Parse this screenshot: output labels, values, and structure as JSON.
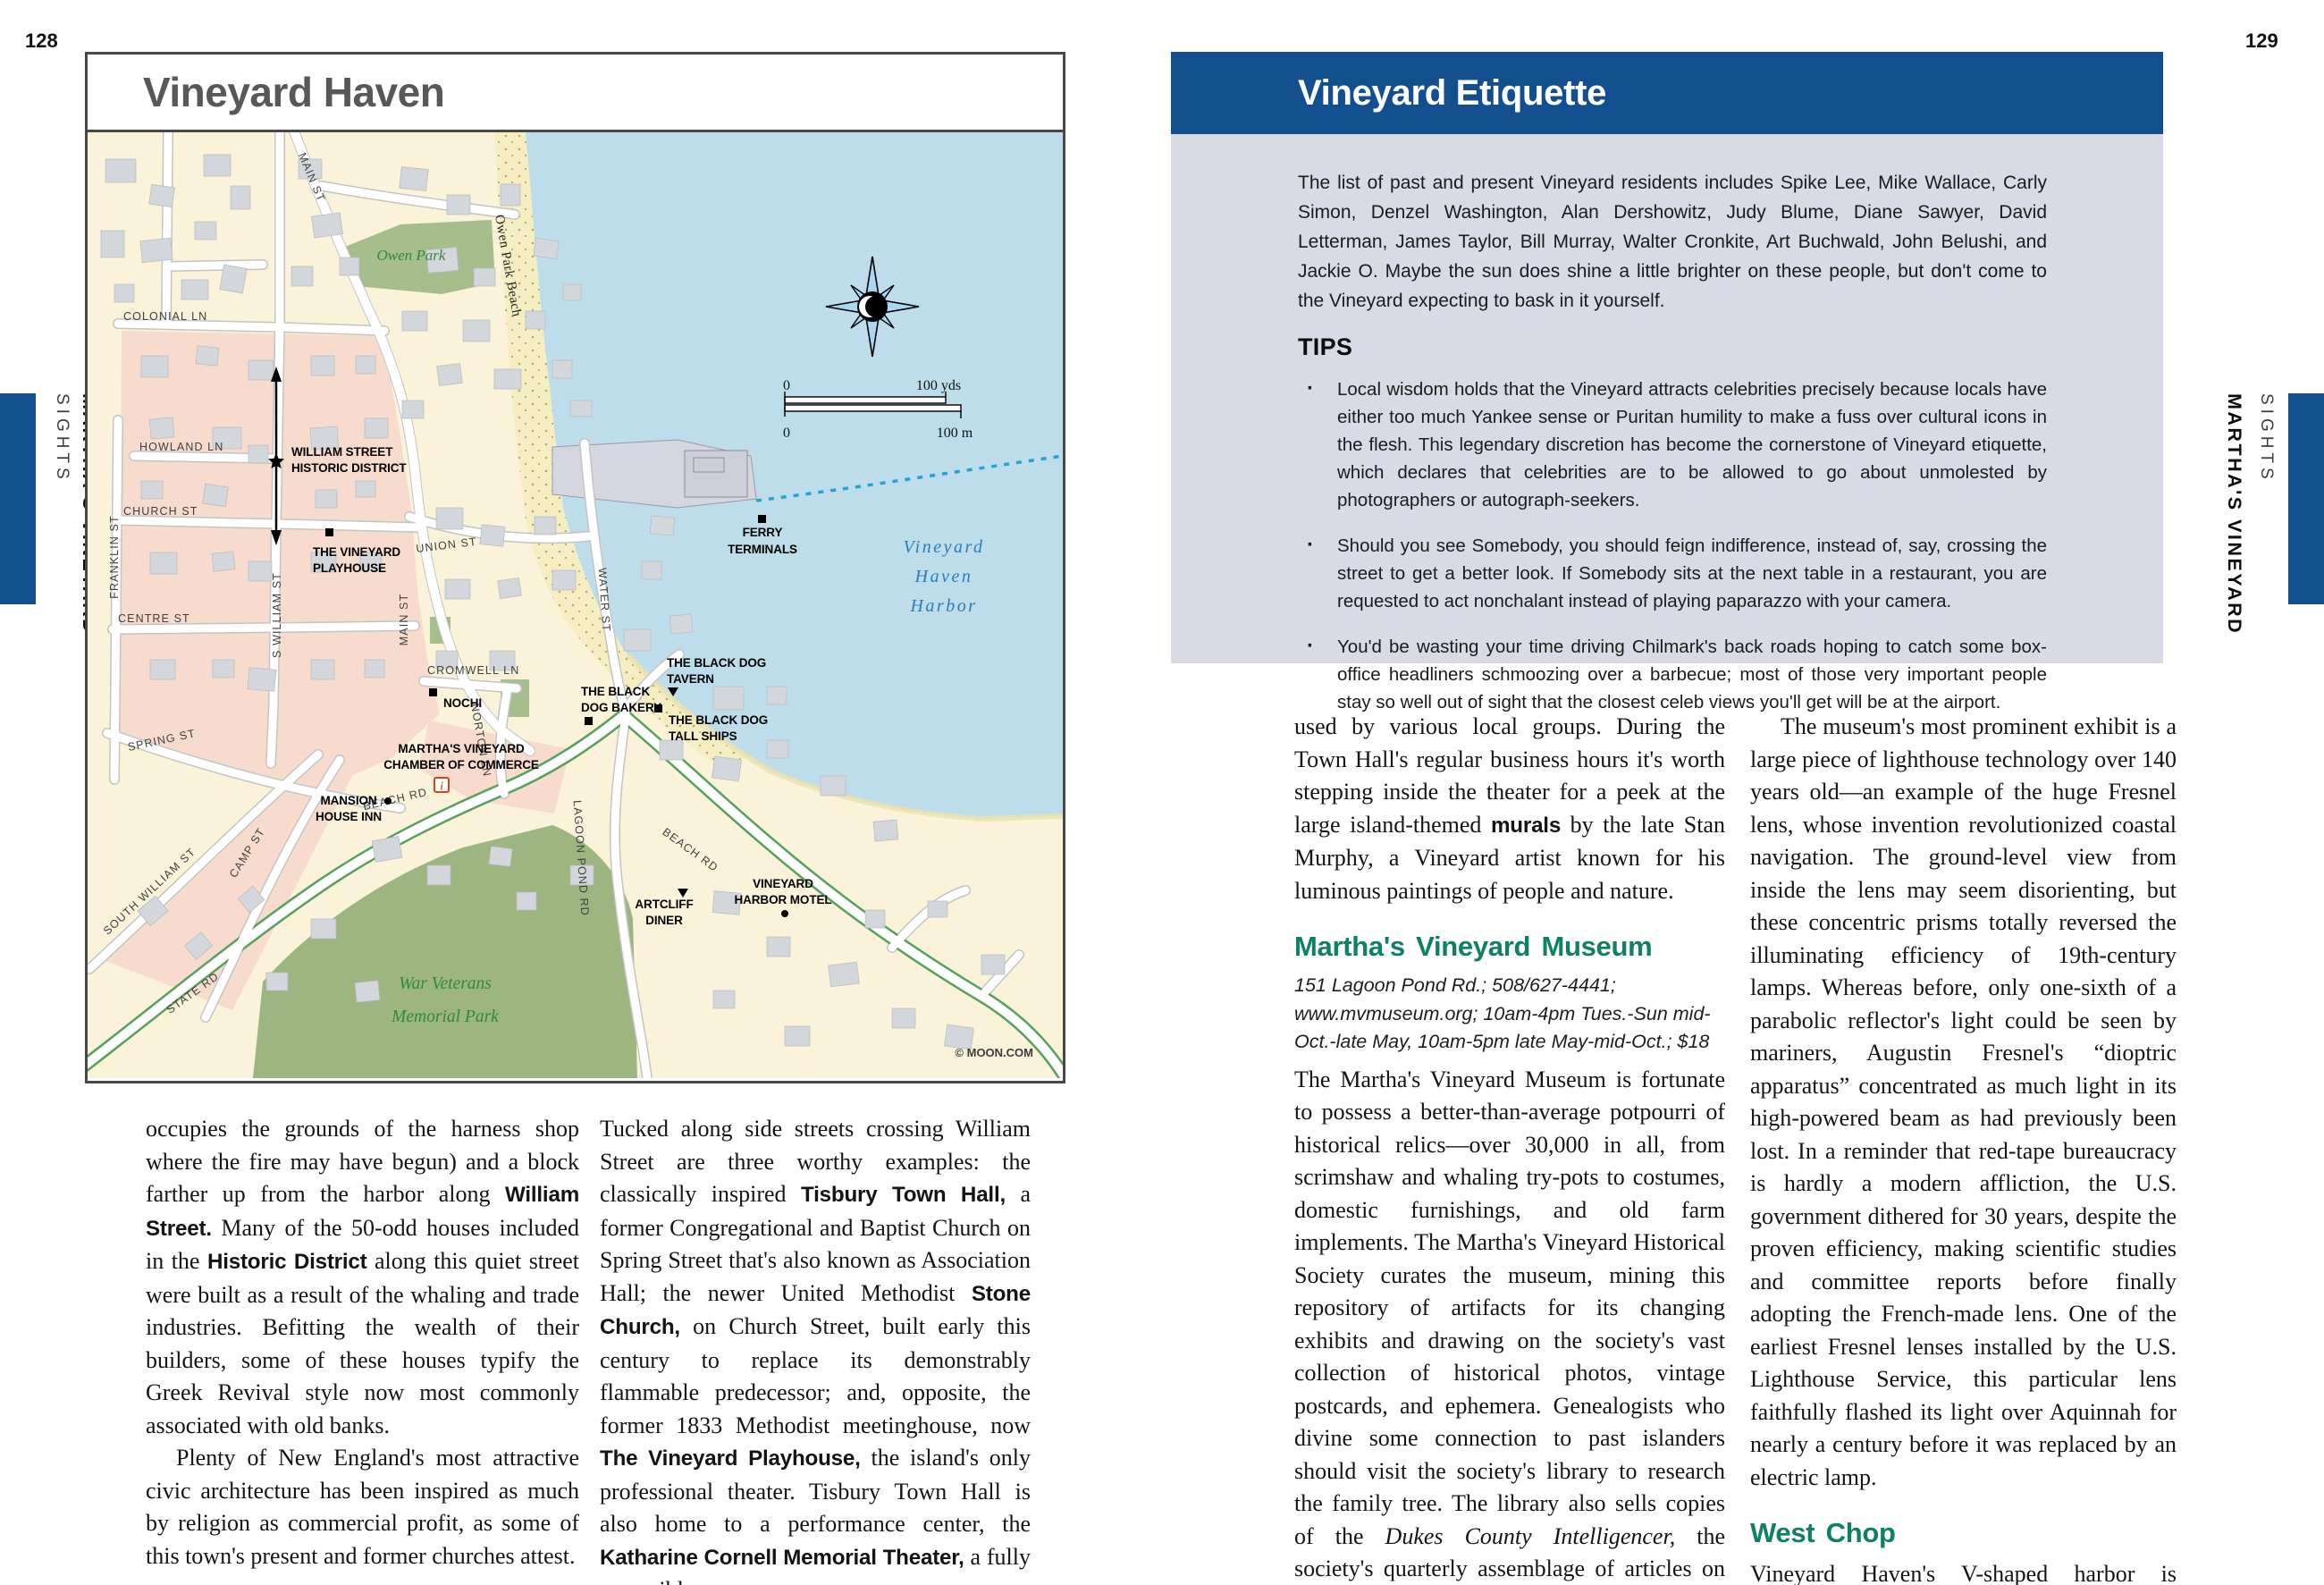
{
  "page_numbers": {
    "left": "128",
    "right": "129"
  },
  "tabs": {
    "chapter": "MARTHA'S VINEYARD",
    "section": "SIGHTS"
  },
  "colors": {
    "accent_blue": "#134f8e",
    "box_lavender": "#d8dbe6",
    "heading_green": "#0e8066",
    "map_water": "#bdddeb",
    "map_land": "#faf3da",
    "map_pink": "#f7dcce",
    "map_park": "#a6bd8e",
    "map_beach": "#f5eec2",
    "map_green_text": "#2f8a3f",
    "harbor_text_blue": "#2e7cb5"
  },
  "map": {
    "title": "Vineyard Haven",
    "copyright": "© MOON.COM",
    "info_icon_glyph": "i",
    "streets": {
      "main_upper": "MAIN ST",
      "main_lower": "MAIN ST",
      "colonial": "COLONIAL LN",
      "howland": "HOWLAND LN",
      "church": "CHURCH ST",
      "centre": "CENTRE ST",
      "spring": "SPRING ST",
      "franklin": "FRANKLIN ST",
      "s_william": "S WILLIAM ST",
      "union": "UNION ST",
      "water": "WATER ST",
      "cromwell": "CROMWELL LN",
      "norton": "NORTON LN",
      "beach_1": "BEACH RD",
      "beach_2": "BEACH RD",
      "lagoon": "LAGOON POND RD",
      "south_william": "SOUTH WILLIAM ST",
      "camp": "CAMP ST",
      "state": "STATE RD"
    },
    "pois": {
      "historic_1": "WILLIAM STREET",
      "historic_2": "HISTORIC DISTRICT",
      "playhouse_1": "THE VINEYARD",
      "playhouse_2": "PLAYHOUSE",
      "ferry_1": "FERRY",
      "ferry_2": "TERMINALS",
      "tavern_1": "THE BLACK DOG",
      "tavern_2": "TAVERN",
      "bakery_1": "THE BLACK",
      "bakery_2": "DOG BAKERY",
      "tallships_1": "THE BLACK DOG",
      "tallships_2": "TALL SHIPS",
      "nochi": "NOCHI",
      "chamber_1": "MARTHA'S VINEYARD",
      "chamber_2": "CHAMBER OF COMMERCE",
      "mansion_1": "MANSION",
      "mansion_2": "HOUSE INN",
      "artcliff_1": "ARTCLIFF",
      "artcliff_2": "DINER",
      "motel_1": "VINEYARD",
      "motel_2": "HARBOR MOTEL"
    },
    "parks": {
      "owen": "Owen Park",
      "owen_beach": "Owen Park Beach",
      "war_1": "War Veterans",
      "war_2": "Memorial Park"
    },
    "harbor": {
      "l1": "Vineyard",
      "l2": "Haven",
      "l3": "Harbor"
    },
    "scale": {
      "y0": "0",
      "yds": "100 yds",
      "m0": "0",
      "m": "100 m"
    }
  },
  "left_col1": {
    "p1": [
      {
        "t": "occupies the grounds of the harness shop where the fire may have begun) and a block farther up from the harbor along "
      },
      {
        "t": "William Street.",
        "c": "b"
      },
      {
        "t": " Many of the 50-odd houses included in the "
      },
      {
        "t": "Historic District",
        "c": "b"
      },
      {
        "t": " along this quiet street were built as a result of the whaling and trade industries. Befitting the wealth of their builders, some of these houses typify the Greek Revival style now most commonly associated with old banks."
      }
    ],
    "p2": [
      {
        "t": "Plenty of New England's most attractive civic architecture has been inspired as much by religion as commercial profit, as some of this town's present and former churches attest."
      }
    ]
  },
  "left_col2": {
    "p1": [
      {
        "t": "Tucked along side streets crossing William Street are three worthy examples: the classically inspired "
      },
      {
        "t": "Tisbury Town Hall,",
        "c": "b"
      },
      {
        "t": " a former Congregational and Baptist Church on Spring Street that's also known as Association Hall; the newer United Methodist "
      },
      {
        "t": "Stone Church,",
        "c": "b"
      },
      {
        "t": " on Church Street, built early this century to replace its demonstrably flammable predecessor; and, opposite, the former 1833 Methodist meetinghouse, now "
      },
      {
        "t": "The Vineyard Playhouse,",
        "c": "b"
      },
      {
        "t": " the island's only professional theater. Tisbury Town Hall is also home to a performance center, the "
      },
      {
        "t": "Katharine Cornell Memorial Theater,",
        "c": "b"
      },
      {
        "t": " a fully accessible space"
      }
    ]
  },
  "etiquette": {
    "title": "Vineyard Etiquette",
    "intro": "The list of past and present Vineyard residents includes Spike Lee, Mike Wallace, Carly Simon, Denzel Washington, Alan Dershowitz, Judy Blume, Diane Sawyer, David Letterman, James Taylor, Bill Murray, Walter Cronkite, Art Buchwald, John Belushi, and Jackie O. Maybe the sun does shine a little brighter on these people, but don't come to the Vineyard expecting to bask in it yourself.",
    "tips_title": "TIPS",
    "tips": [
      "Local wisdom holds that the Vineyard attracts celebrities precisely because locals have either too much Yankee sense or Puritan humility to make a fuss over cultural icons in the flesh. This legendary discretion has become the cornerstone of Vineyard etiquette, which declares that celebrities are to be allowed to go about unmolested by photographers or autograph-seekers.",
      "Should you see Somebody, you should feign indifference, instead of, say, crossing the street to get a better look. If Somebody sits at the next table in a restaurant, you are requested to act nonchalant instead of playing paparazzo with your camera.",
      "You'd be wasting your time driving Chilmark's back roads hoping to catch some box-office headliners schmoozing over a barbecue; most of those very important people stay so well out of sight that the closest celeb views you'll get will be at the airport."
    ]
  },
  "right_col1": {
    "p1": [
      {
        "t": "used by various local groups. During the Town Hall's regular business hours it's worth stepping inside the theater for a peek at the large island-themed "
      },
      {
        "t": "murals",
        "c": "b"
      },
      {
        "t": " by the late Stan Murphy, a Vineyard artist known for his luminous paintings of people and nature."
      }
    ],
    "heading": "Martha's Vineyard Museum",
    "info": "151 Lagoon Pond Rd.; 508/627-4441; www.mvmuseum.org; 10am-4pm Tues.-Sun mid-Oct.-late May, 10am-5pm late May-mid-Oct.; $18",
    "p2": [
      {
        "t": "The Martha's Vineyard Museum is fortunate to possess a better-than-average potpourri of historical relics—over 30,000 in all, from scrimshaw and whaling try-pots to costumes, domestic furnishings, and old farm implements. The Martha's Vineyard Historical Society curates the museum, mining this repository of artifacts for its changing exhibits and drawing on the society's vast collection of historical photos, vintage postcards, and ephemera. Genealogists who divine some connection to past islanders should visit the society's library to research the family tree. The library also sells copies of the "
      },
      {
        "t": "Dukes County Intelligencer,",
        "c": "i"
      },
      {
        "t": " the society's quarterly assemblage of articles on island history and lore."
      }
    ]
  },
  "right_col2": {
    "p1": [
      {
        "t": "The museum's most prominent exhibit is a large piece of lighthouse technology over 140 years old—an example of the huge Fresnel lens, whose invention revolutionized coastal navigation. The ground-level view from inside the lens may seem disorienting, but these concentric prisms totally reversed the illuminating efficiency of 19th-century lamps. Whereas before, only one-sixth of a parabolic reflector's light could be seen by mariners, Augustin Fresnel's “dioptric apparatus” concentrated as much light in its high-powered beam as had previously been lost. In a reminder that red-tape bureaucracy is hardly a modern affliction, the U.S. government dithered for 30 years, despite the proven efficiency, making scientific studies and committee reports before finally adopting the French-made lens. One of the earliest Fresnel lenses installed by the U.S. Lighthouse Service, this particular lens faithfully flashed its light over Aquinnah for nearly a century before it was replaced by an electric lamp."
      }
    ],
    "heading": "West Chop",
    "p2": [
      {
        "t": "Vineyard Haven's V-shaped harbor is protected on either side by jaw-like hunks"
      }
    ]
  }
}
